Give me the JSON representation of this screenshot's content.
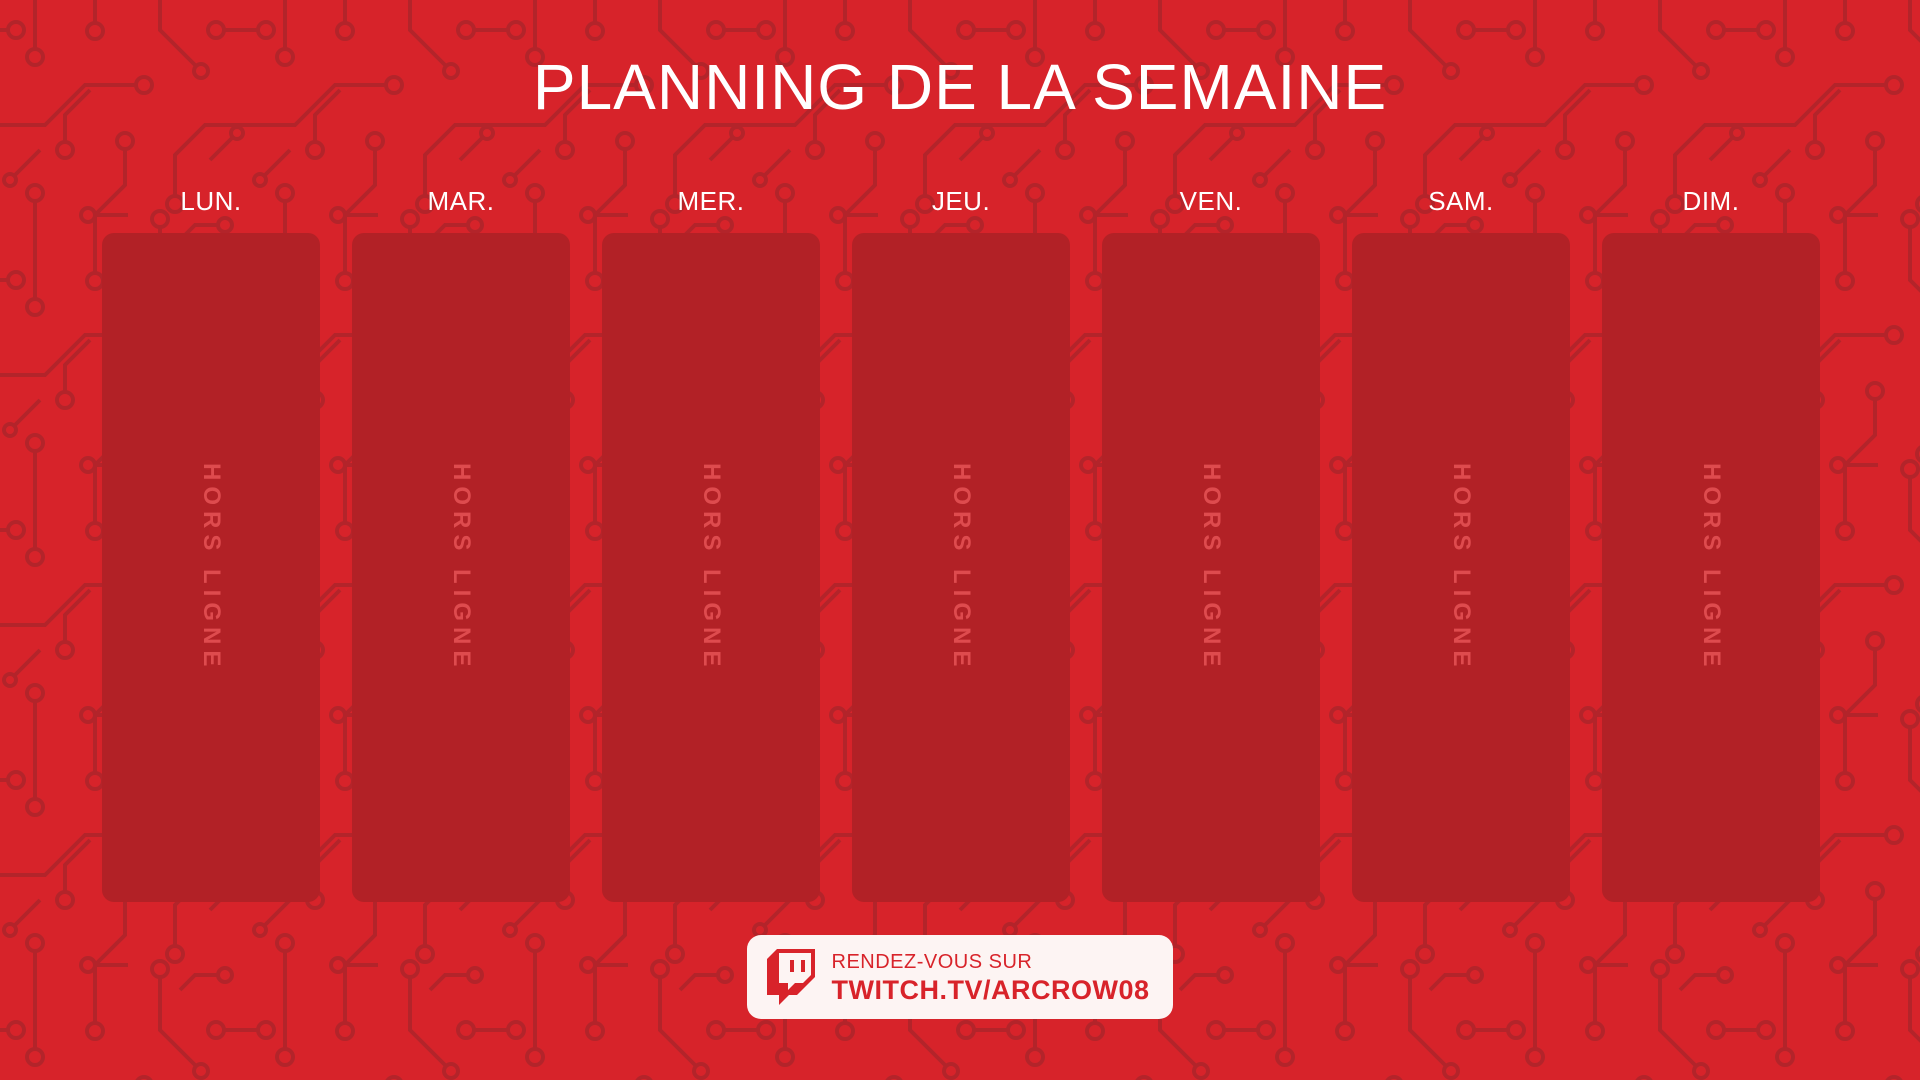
{
  "app": {
    "title": "PLANNING DE LA SEMAINE"
  },
  "schedule": {
    "days": [
      {
        "label": "LUN.",
        "status": "HORS LIGNE"
      },
      {
        "label": "MAR.",
        "status": "HORS LIGNE"
      },
      {
        "label": "MER.",
        "status": "HORS LIGNE"
      },
      {
        "label": "JEU.",
        "status": "HORS LIGNE"
      },
      {
        "label": "VEN.",
        "status": "HORS LIGNE"
      },
      {
        "label": "SAM.",
        "status": "HORS LIGNE"
      },
      {
        "label": "DIM.",
        "status": "HORS LIGNE"
      }
    ]
  },
  "footer": {
    "icon": "twitch-logo-icon",
    "line1": "RENDEZ-VOUS SUR",
    "line2": "TWITCH.TV/ARCROW08"
  },
  "colors": {
    "background": "#d7232a",
    "circuit_trace": "#b3242a",
    "card": "#b22126",
    "offline_text": "#de4b4e",
    "heading_text": "#ffffff",
    "badge_background": "#fdf4f3",
    "badge_red": "#d8232a"
  }
}
